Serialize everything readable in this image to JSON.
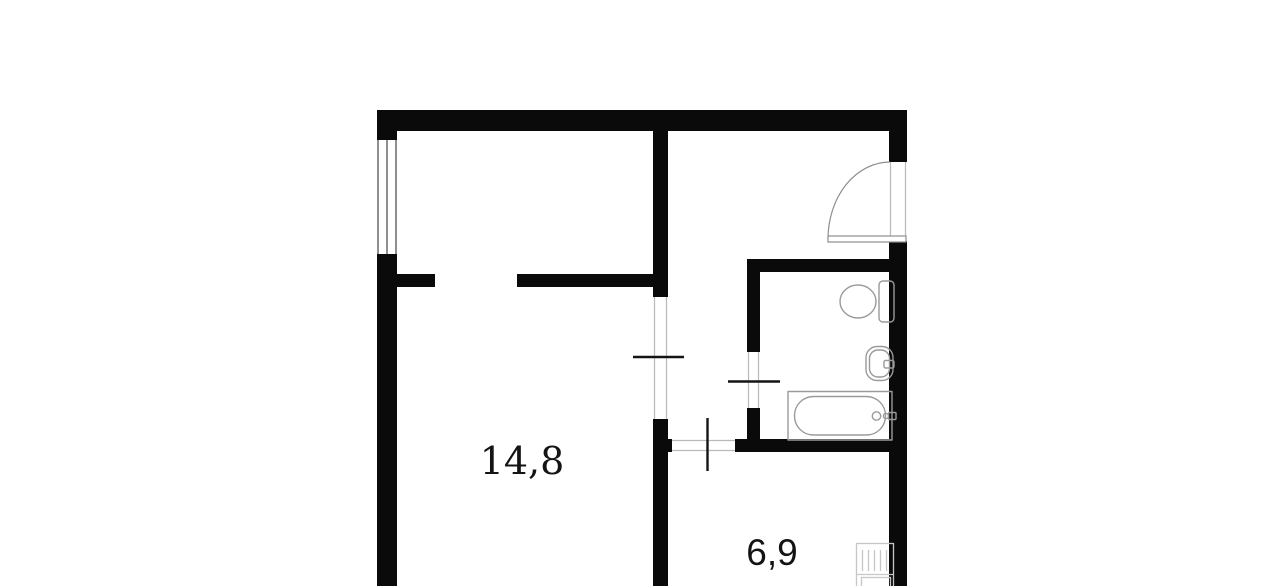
{
  "plan": {
    "type": "apartment-floor-plan",
    "background_color": "#ffffff",
    "wall_color": "#0a0a0a",
    "window_line_color": "#5f5f5f",
    "opening_line_color": "#b9b9b9",
    "opening_tick_color": "#141414",
    "door_line_color": "#8e8e8e",
    "fixture_line_color": "#9a9a9a",
    "stove_line_color": "#c7c7c7",
    "label_color": "#141414",
    "rooms": [
      {
        "name": "room",
        "area_label": "14,8"
      },
      {
        "name": "kitchen",
        "area_label": "6,9"
      }
    ],
    "fixtures": [
      "window",
      "entrance-door",
      "toilet",
      "sink",
      "bathtub",
      "stove"
    ]
  }
}
